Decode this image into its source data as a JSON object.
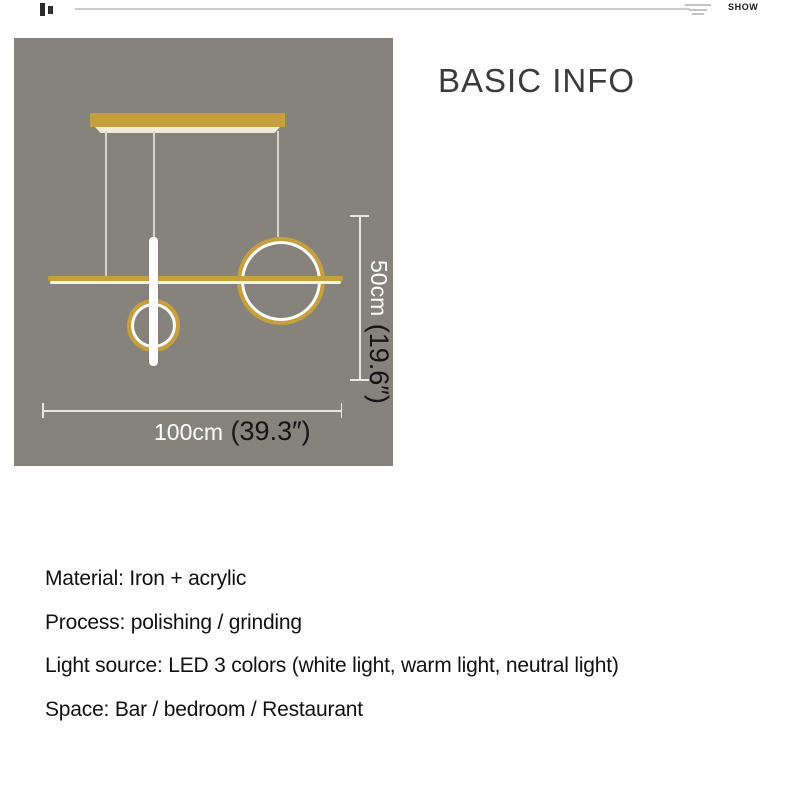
{
  "topbar": {
    "show_label": "SHOW"
  },
  "header": {
    "title": "BASIC INFO"
  },
  "diagram": {
    "height_cm": "50cm",
    "height_in": " (19.6″)",
    "width_cm": "100cm",
    "width_in": " (39.3″)",
    "colors": {
      "panel_bg": "#86837d",
      "lamp_gold": "#c6a03d",
      "lamp_led_white": "#ffffff",
      "dimension_line": "#e8e6e1",
      "dimension_cm_text": "#ffffff",
      "dimension_in_text": "#151515"
    }
  },
  "specs": [
    "Material: Iron + acrylic",
    "Process: polishing / grinding",
    "Light source: LED 3 colors (white light, warm light, neutral light)",
    "Space: Bar / bedroom / Restaurant"
  ]
}
